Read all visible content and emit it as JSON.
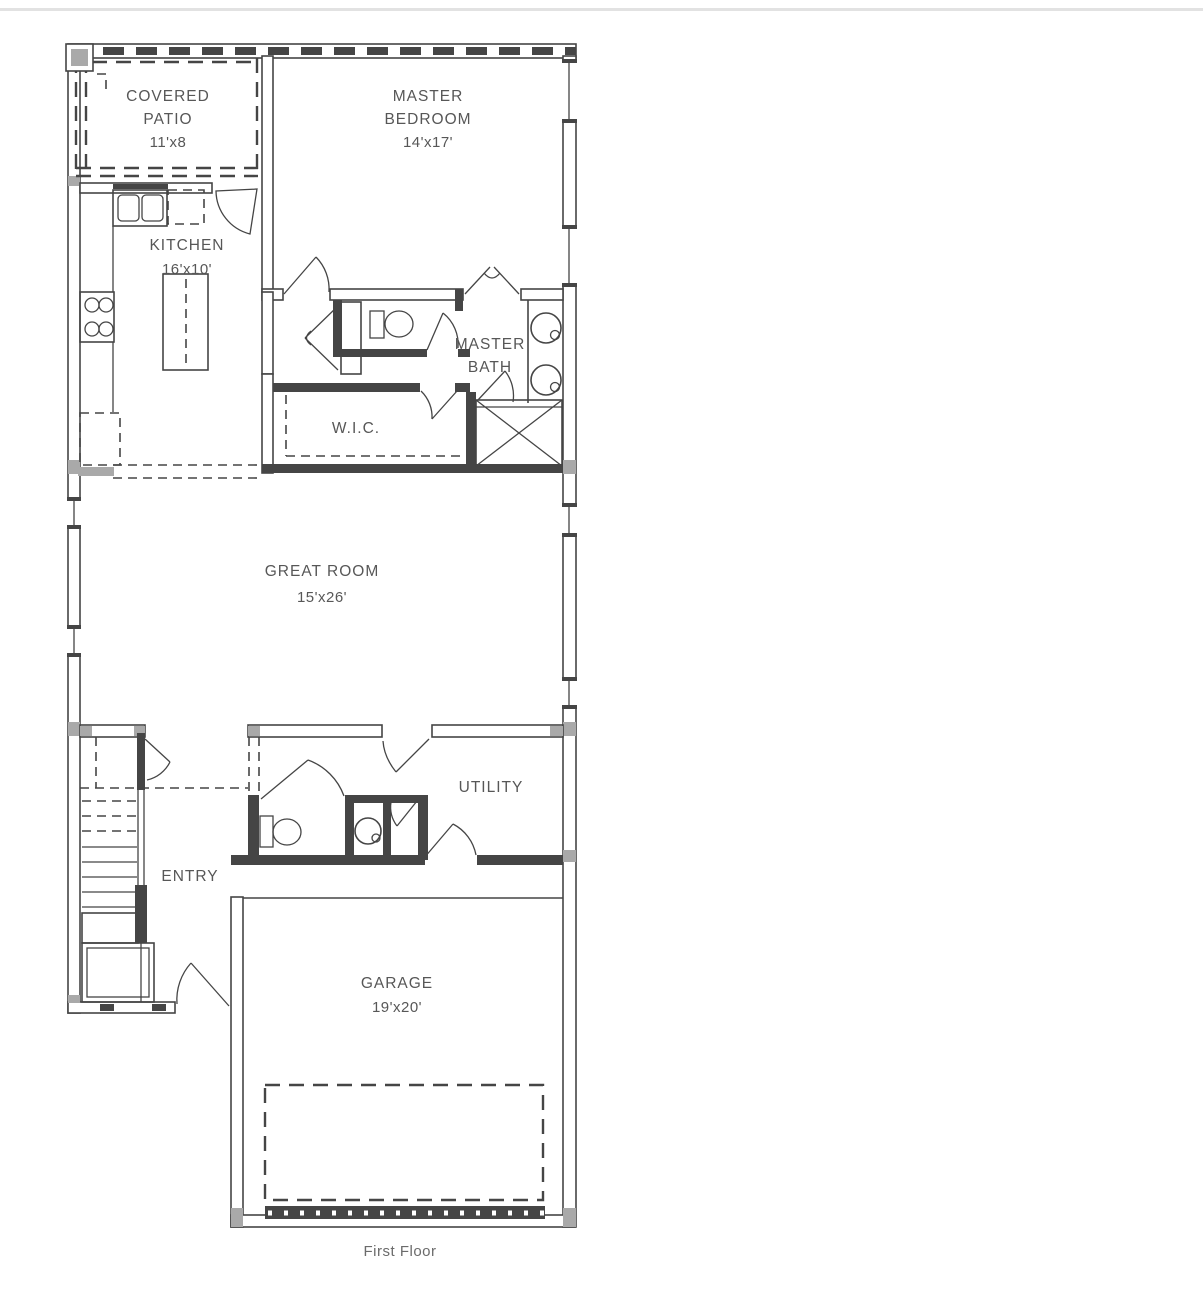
{
  "caption": "First Floor",
  "rooms": {
    "covered_patio": {
      "line1": "COVERED",
      "line2": "PATIO",
      "dims": "11'x8"
    },
    "master_bedroom": {
      "line1": "MASTER",
      "line2": "BEDROOM",
      "dims": "14'x17'"
    },
    "kitchen": {
      "name": "KITCHEN",
      "dims": "16'x10'"
    },
    "master_bath": {
      "line1": "MASTER",
      "line2": "BATH"
    },
    "wic": {
      "name": "W.I.C."
    },
    "great_room": {
      "name": "GREAT ROOM",
      "dims": "15'x26'"
    },
    "entry": {
      "name": "ENTRY"
    },
    "utility": {
      "name": "UTILITY"
    },
    "garage": {
      "name": "GARAGE",
      "dims": "19'x20'"
    }
  },
  "colors": {
    "background": "#ffffff",
    "line": "#454545",
    "wall_fill": "#a9a9a9",
    "label": "#575757",
    "caption": "#6b6b6b"
  }
}
